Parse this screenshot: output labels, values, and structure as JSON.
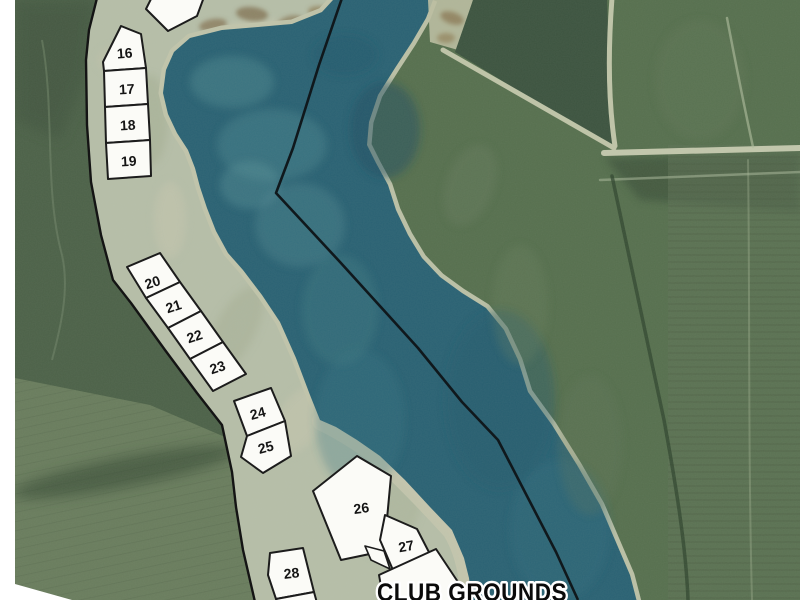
{
  "map": {
    "description": "Aerial plat map of lakeside subdivision lots with club grounds",
    "club_grounds": {
      "label": "CLUB GROUNDS"
    },
    "lots": [
      {
        "label": "16"
      },
      {
        "label": "17"
      },
      {
        "label": "18"
      },
      {
        "label": "19"
      },
      {
        "label": "20"
      },
      {
        "label": "21"
      },
      {
        "label": "22"
      },
      {
        "label": "23"
      },
      {
        "label": "24"
      },
      {
        "label": "25"
      },
      {
        "label": "26"
      },
      {
        "label": "27"
      },
      {
        "label": "28"
      }
    ],
    "colors": {
      "white_margin": "#ffffff",
      "lake": "#2a6274",
      "lake_deep": "#1e5063",
      "lake_shallow": "#4c858e",
      "land_strip": "#b7bfa9",
      "shore_sand": "#c2c5ac",
      "forest_left": "#4d6249",
      "forest_left_dark": "#445842",
      "forest_right": "#57704f",
      "forest_patch_dark": "#3d5440",
      "plantation": "#6a7d5e",
      "road_sand": "#c0c5a9",
      "boundary_line": "#141414",
      "lot_fill": "#fbfbf7",
      "lot_stroke": "#1c1c1c"
    }
  }
}
